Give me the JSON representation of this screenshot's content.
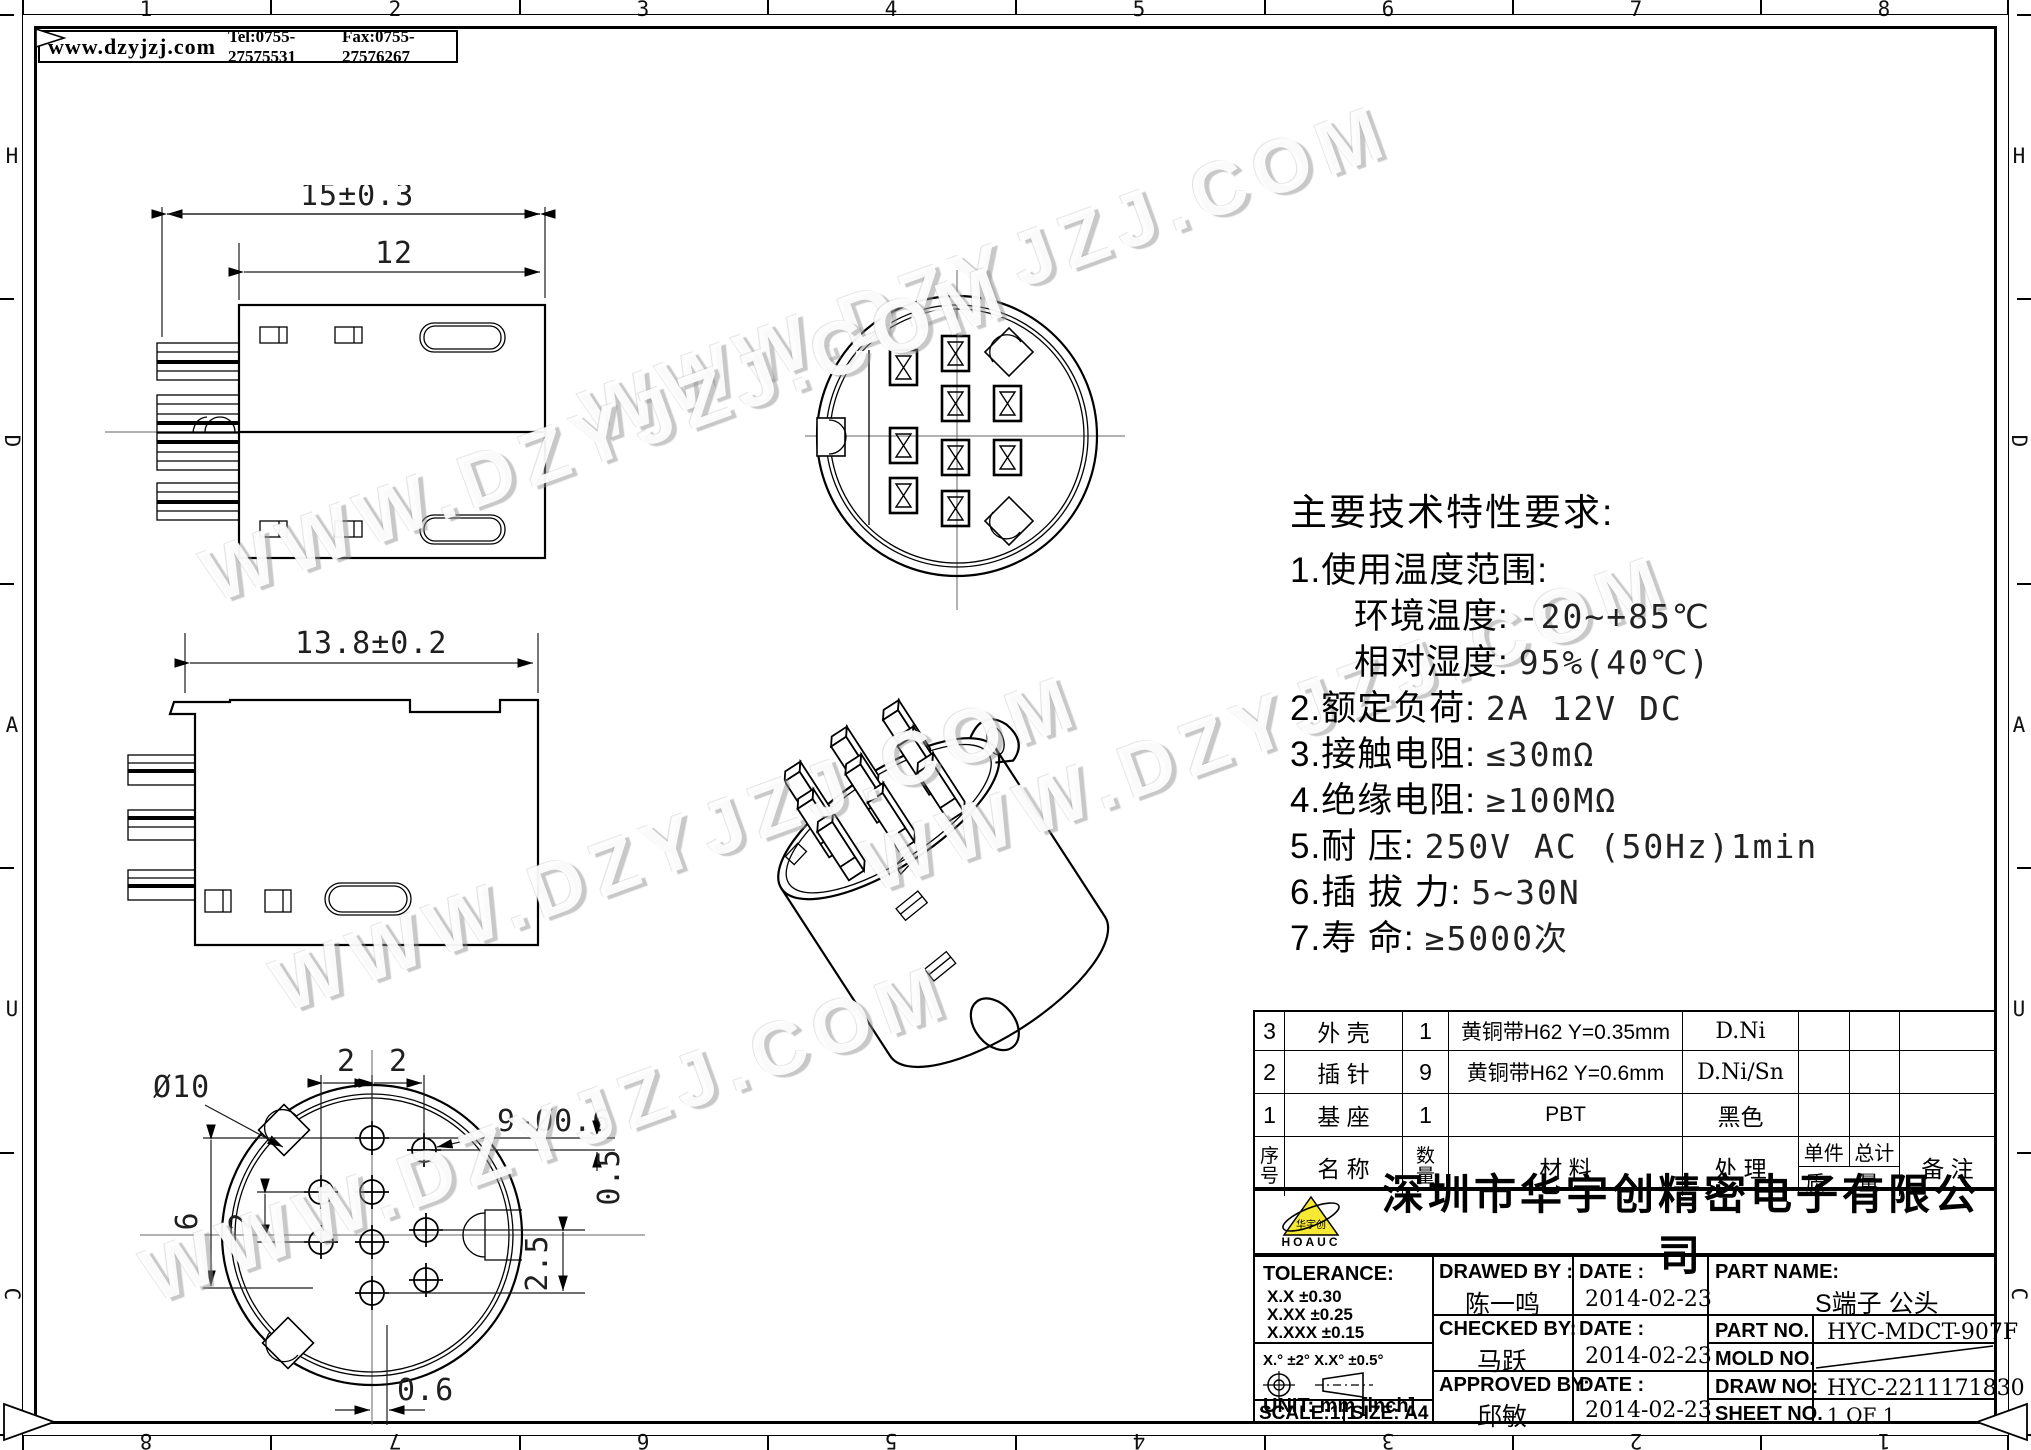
{
  "header": {
    "website": "www.dzyjzj.com",
    "tel": "Tel:0755-27575531",
    "fax": "Fax:0755-27576267"
  },
  "frame": {
    "top_numbers": [
      "1",
      "2",
      "3",
      "4",
      "5",
      "6",
      "7",
      "8"
    ],
    "bottom_numbers": [
      "8",
      "7",
      "6",
      "5",
      "4",
      "3",
      "2",
      "1"
    ],
    "left_letters": [
      "H",
      "D",
      "A",
      "U",
      "C"
    ],
    "right_letters": [
      "H",
      "D",
      "A",
      "U",
      "C"
    ]
  },
  "watermark": {
    "text": "WWW.DZYJZJ.COM"
  },
  "specs": {
    "title": "主要技术特性要求:",
    "lines": [
      {
        "label": "1.使用温度范围:",
        "value": ""
      },
      {
        "label": "环境温度:",
        "value": "-20~+85℃"
      },
      {
        "label": "相对湿度:",
        "value": "95%(40℃)"
      },
      {
        "label": "2.额定负荷:",
        "value": "2A 12V DC"
      },
      {
        "label": "3.接触电阻:",
        "value": "≤30mΩ"
      },
      {
        "label": "4.绝缘电阻:",
        "value": "≥100MΩ"
      },
      {
        "label": "5.耐    压:",
        "value": "250V AC (50Hz)1min"
      },
      {
        "label": "6.插 拔 力:",
        "value": "5~30N"
      },
      {
        "label": "7.寿    命:",
        "value": "≥5000次"
      }
    ]
  },
  "drawings": {
    "view1": {
      "dim_overall": "15±0.3",
      "dim_inner": "12"
    },
    "view2": {
      "dim_overall": "13.8±0.2"
    },
    "view3": {
      "dia": "Ø10",
      "pin_spec": "9-Ø0.6",
      "dim_top_left": "2",
      "dim_top_right": "2",
      "dim_left_outer": "6",
      "dim_left_inner": "2",
      "dim_right_top": "0.5",
      "dim_right_bottom": "2.5",
      "dim_bottom": "0.6"
    }
  },
  "parts_table": {
    "rows": [
      {
        "seq": "3",
        "name": "外 壳",
        "qty": "1",
        "material": "黄铜带H62 Y=0.35mm",
        "treatment": "D.Ni",
        "unit": "",
        "total": "",
        "remark": ""
      },
      {
        "seq": "2",
        "name": "插 针",
        "qty": "9",
        "material": "黄铜带H62 Y=0.6mm",
        "treatment": "D.Ni/Sn",
        "unit": "",
        "total": "",
        "remark": ""
      },
      {
        "seq": "1",
        "name": "基 座",
        "qty": "1",
        "material": "PBT",
        "treatment": "黑色",
        "unit": "",
        "total": "",
        "remark": ""
      }
    ],
    "header": {
      "seq_top": "序",
      "seq_bot": "号",
      "name": "名  称",
      "qty_top": "数",
      "qty_bot": "量",
      "material": "材   料",
      "treatment": "处  理",
      "unit": "单件",
      "total": "总计",
      "mass": "质 量",
      "remark": "备  注"
    }
  },
  "title_block": {
    "company": "深圳市华宇创精密电子有限公司",
    "logo_text": "HOAUC",
    "logo_mark": "华宇创",
    "tolerance": {
      "title": "TOLERANCE:",
      "row1": "X.X    ±0.30",
      "row2": "X.XX   ±0.25",
      "row3": "X.XXX  ±0.15",
      "angles": "X.° ±2°    X.X° ±0.5°"
    },
    "unit": "UNIT:  mm  [inch]",
    "scale": "SCALE:1:1",
    "size": "SIZE:  A4",
    "drawed": {
      "label": "DRAWED BY :",
      "name": "陈一鸣",
      "date_label": "DATE :",
      "date": "2014-02-23"
    },
    "checked": {
      "label": "CHECKED BY:",
      "name": "马跃",
      "date_label": "DATE :",
      "date": "2014-02-23"
    },
    "approved": {
      "label": "APPROVED BY:",
      "name": "邱敏",
      "date_label": "DATE :",
      "date": "2014-02-23"
    },
    "part_name": {
      "label": "PART NAME:",
      "value": "S端子 公头"
    },
    "part_no": {
      "label": "PART NO.",
      "value": "HYC-MDCT-907F"
    },
    "mold_no": {
      "label": "MOLD NO.",
      "value": ""
    },
    "draw_no": {
      "label": "DRAW NO:",
      "value": "HYC-2211171830"
    },
    "sheet_no": {
      "label": "SHEET NO.",
      "value": "1 OF 1"
    }
  },
  "colors": {
    "logo_yellow": "#f6e934",
    "line": "#000000"
  }
}
